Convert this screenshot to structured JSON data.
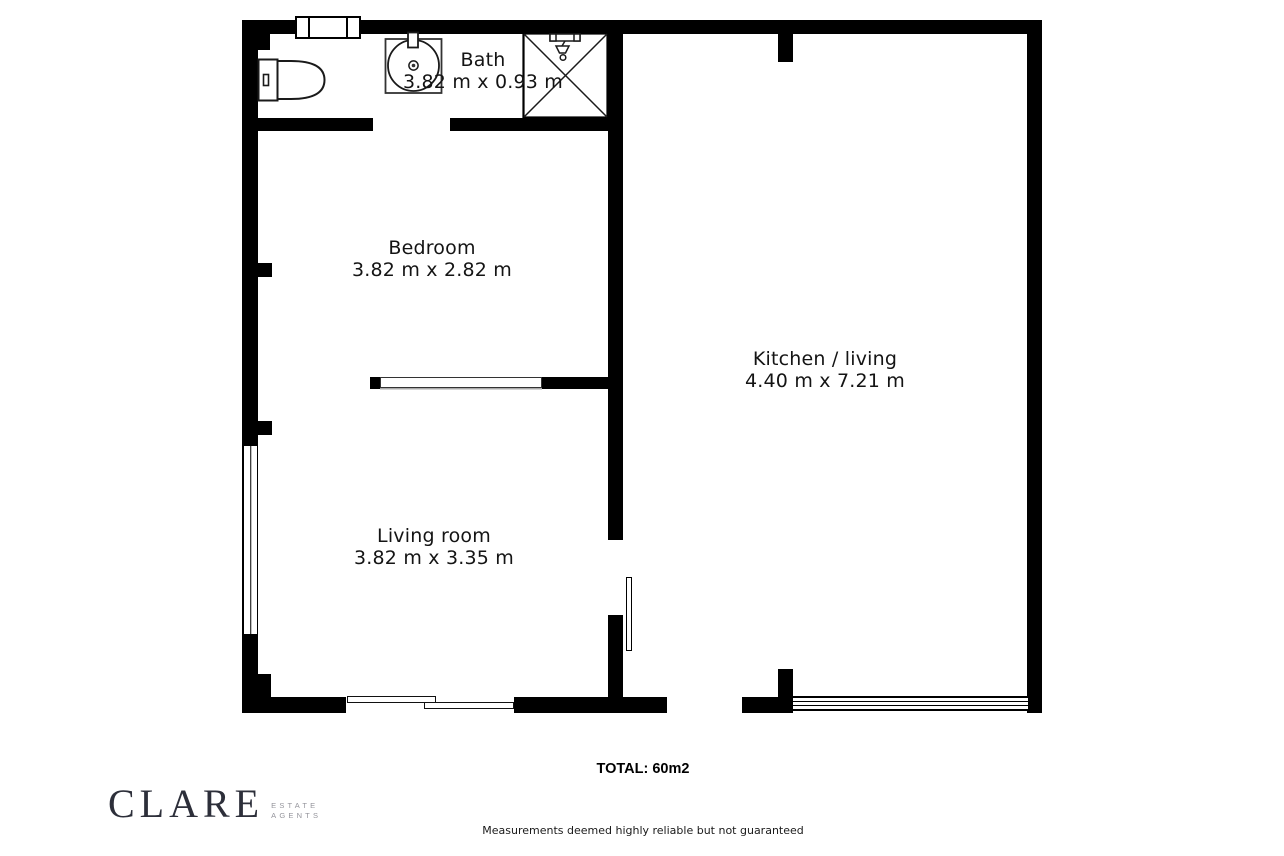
{
  "floorplan": {
    "wall_color": "#000000",
    "background": "#ffffff",
    "rooms": [
      {
        "name": "Bath",
        "dimensions": "3.82 m x 0.93 m"
      },
      {
        "name": "Bedroom",
        "dimensions": "3.82 m x 2.82 m"
      },
      {
        "name": "Kitchen / living",
        "dimensions": "4.40 m x 7.21 m"
      },
      {
        "name": "Living room",
        "dimensions": "3.82 m x 3.35 m"
      }
    ],
    "fixtures": [
      "toilet-icon",
      "sink-icon",
      "shower-icon"
    ],
    "total": "TOTAL: 60m2"
  },
  "footer": {
    "brand": "CLARE",
    "brand_tagline_line1": "ESTATE",
    "brand_tagline_line2": "AGENTS",
    "disclaimer": "Measurements deemed highly reliable but not guaranteed"
  }
}
